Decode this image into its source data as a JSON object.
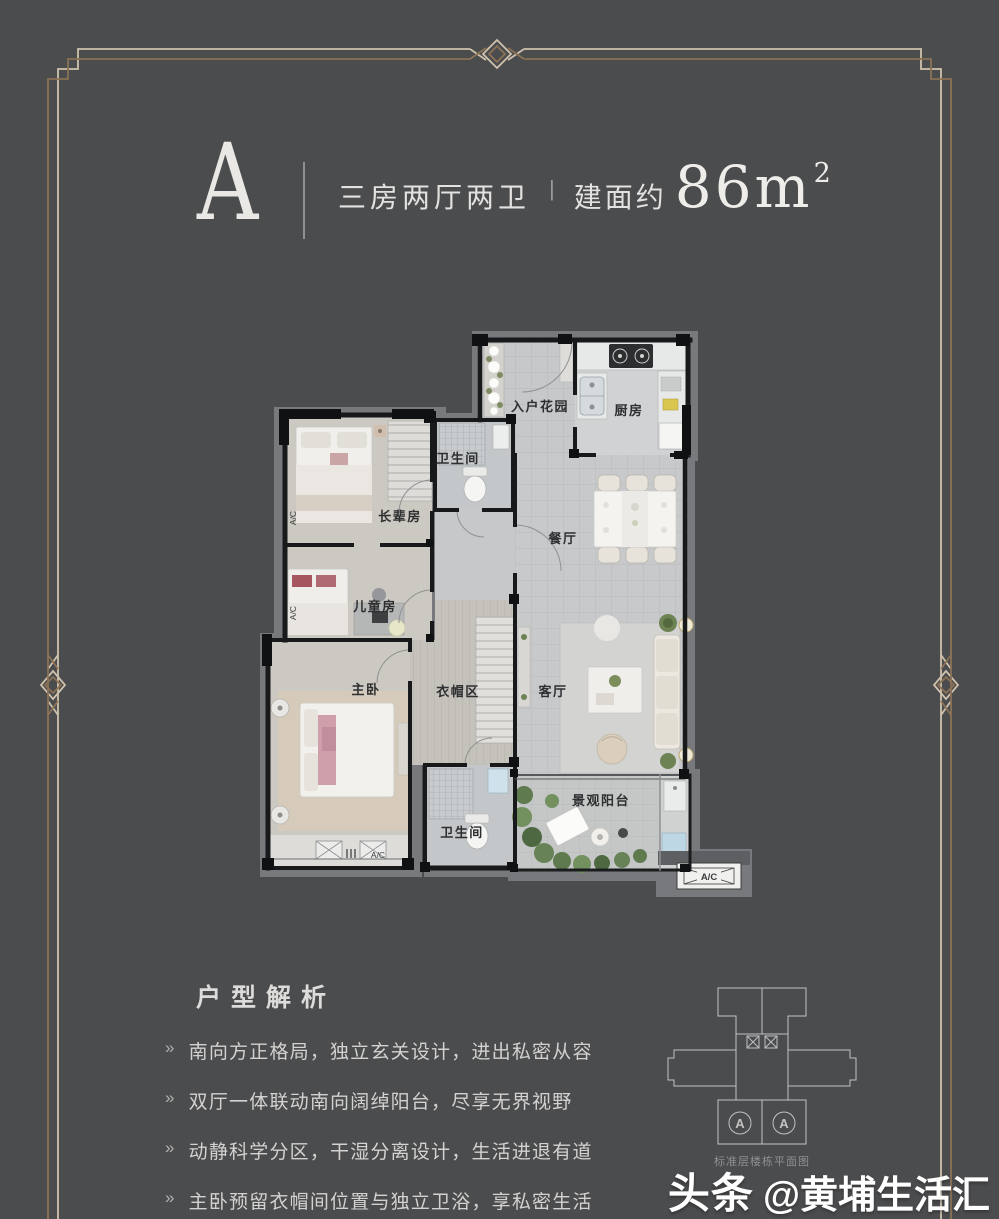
{
  "page": {
    "background": "#4b4c4e",
    "frame_light": "#cfc2ad",
    "frame_dark": "#8b7256"
  },
  "header": {
    "unit_letter": "A",
    "layout_text": "三房两厅两卫",
    "separator": "|",
    "area_label": "建面约",
    "area_number": "86m",
    "area_exponent": "2"
  },
  "floorplan": {
    "rooms": [
      {
        "id": "entry-garden",
        "name": "入户花园"
      },
      {
        "id": "kitchen",
        "name": "厨房"
      },
      {
        "id": "bath-top",
        "name": "卫生间"
      },
      {
        "id": "elder-room",
        "name": "长辈房"
      },
      {
        "id": "dining-room",
        "name": "餐厅"
      },
      {
        "id": "children-room",
        "name": "儿童房"
      },
      {
        "id": "master-bedroom",
        "name": "主卧"
      },
      {
        "id": "cloak-area",
        "name": "衣帽区"
      },
      {
        "id": "living-room",
        "name": "客厅"
      },
      {
        "id": "bath-bottom",
        "name": "卫生间"
      },
      {
        "id": "balcony",
        "name": "景观阳台"
      }
    ],
    "ac_label": "A/C"
  },
  "analysis": {
    "title": "户型解析",
    "bullet_glyph": "»",
    "items": [
      "南向方正格局，独立玄关设计，进出私密从容",
      "双厅一体联动南向阔绰阳台，尽享无界视野",
      "动静科学分区，干湿分离设计，生活进退有道",
      "主卧预留衣帽间位置与独立卫浴，享私密生活"
    ]
  },
  "keyplan": {
    "caption": "标准层楼栋平面图",
    "unit_marker": "A"
  },
  "watermark": {
    "brand": "头条",
    "handle": "@黄埔生活汇"
  }
}
